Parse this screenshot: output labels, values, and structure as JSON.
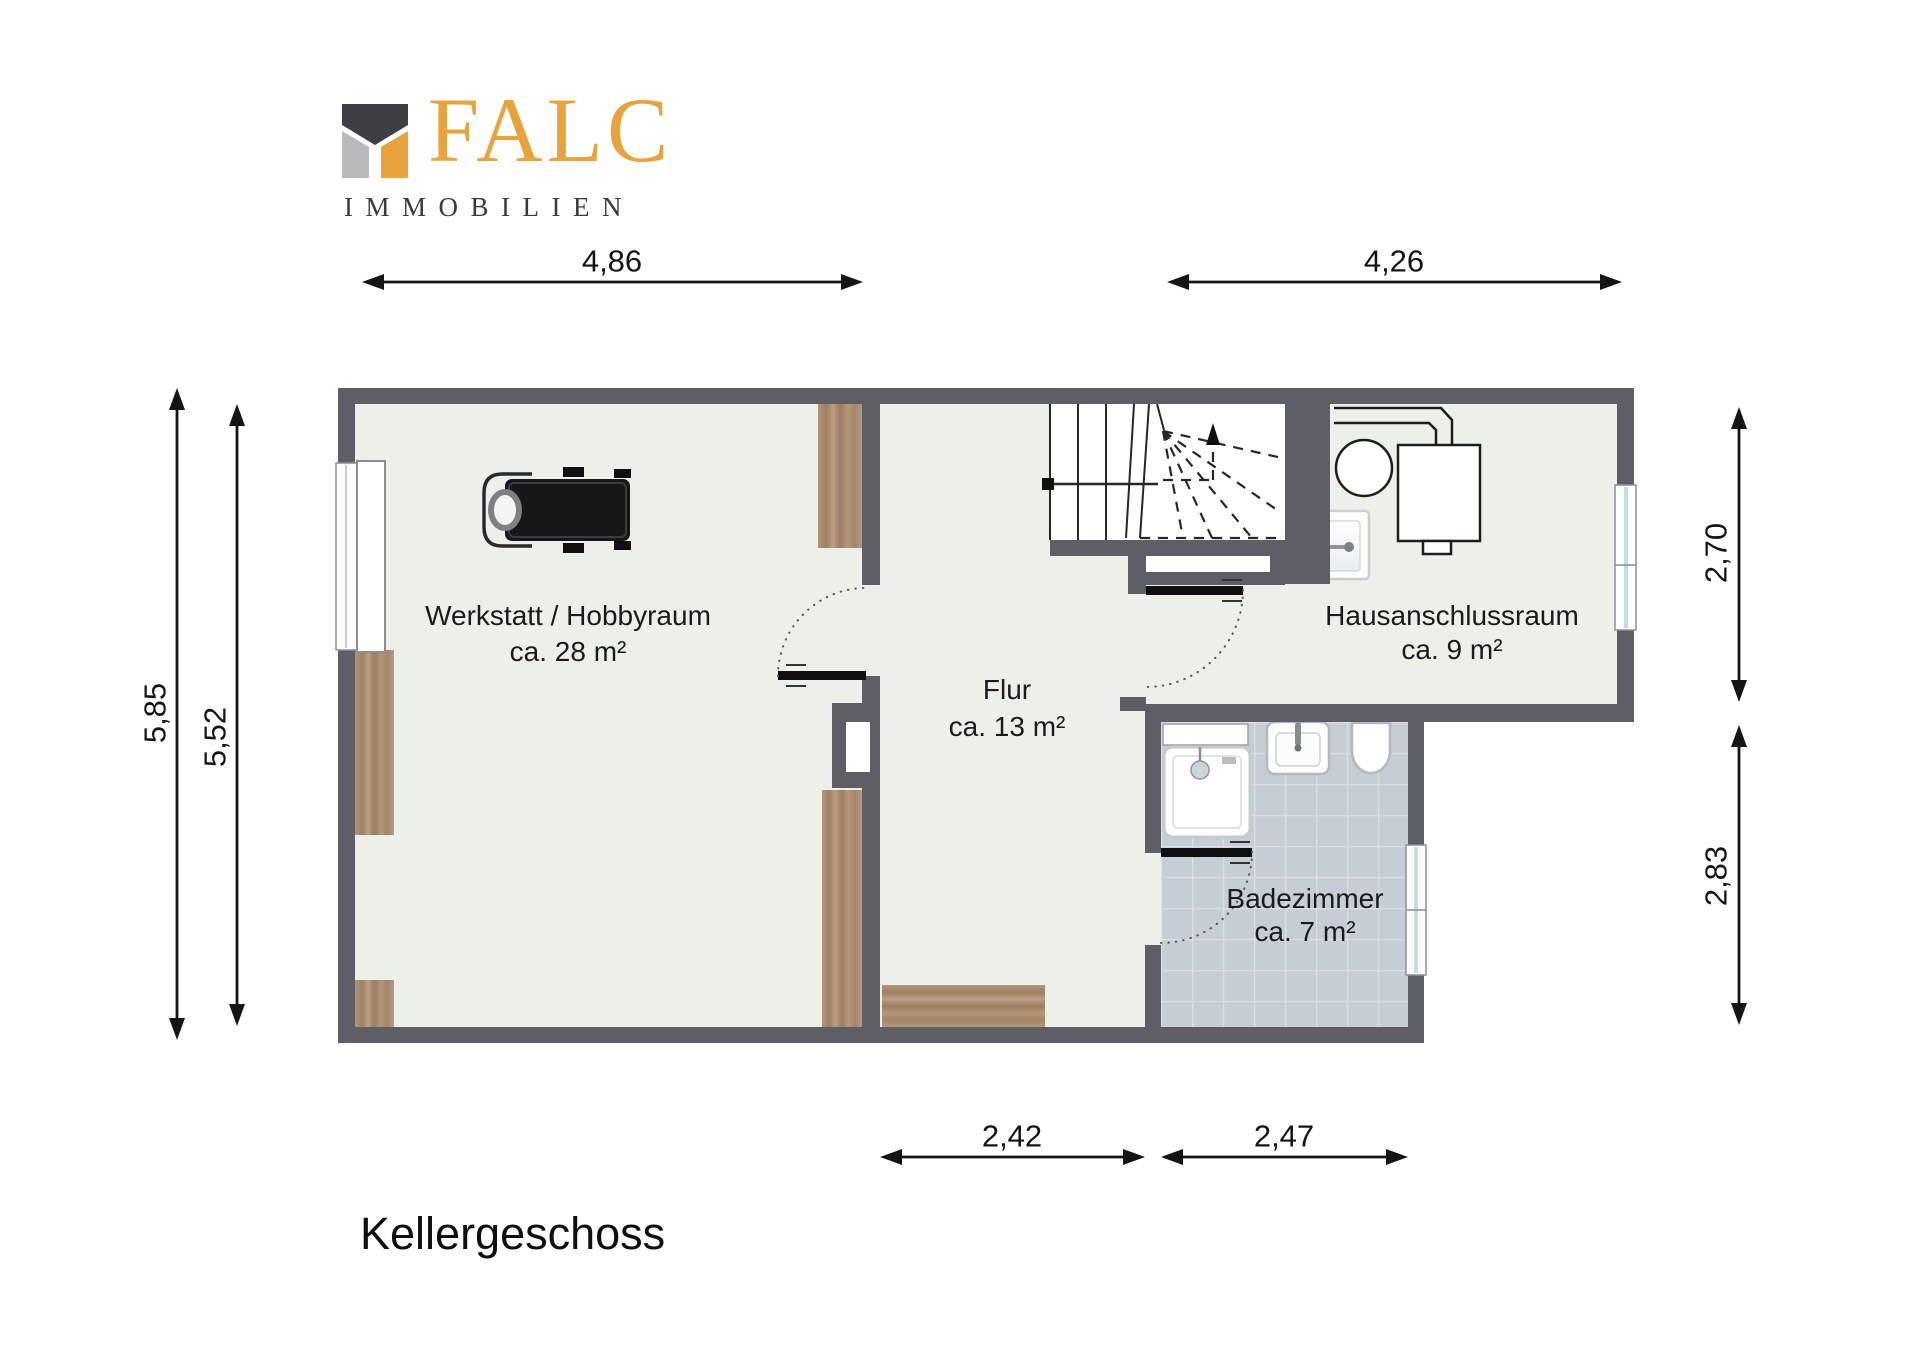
{
  "logo": {
    "brand": "FALC",
    "subtitle": "IMMOBILIEN"
  },
  "title": "Kellergeschoss",
  "rooms": {
    "werkstatt": {
      "name": "Werkstatt / Hobbyraum",
      "area": "ca. 28 m²"
    },
    "flur": {
      "name": "Flur",
      "area": "ca. 13 m²"
    },
    "hausanschluss": {
      "name": "Hausanschlussraum",
      "area": "ca. 9 m²"
    },
    "bad": {
      "name": "Badezimmer",
      "area": "ca. 7 m²"
    }
  },
  "dimensions": {
    "top_left": "4,86",
    "top_right": "4,26",
    "left_outer": "5,85",
    "left_inner": "5,52",
    "right_upper": "2,70",
    "right_lower": "2,83",
    "bottom_flur": "2,42",
    "bottom_bad": "2,47"
  },
  "colors": {
    "brand_orange": "#e8a33c",
    "brand_dark": "#3e3e45",
    "brand_gray": "#b9b9bc",
    "wall": "#5e5f66",
    "floor": "#edefe9",
    "tile": "#c6cdd4",
    "wood": "#ab8c70"
  }
}
